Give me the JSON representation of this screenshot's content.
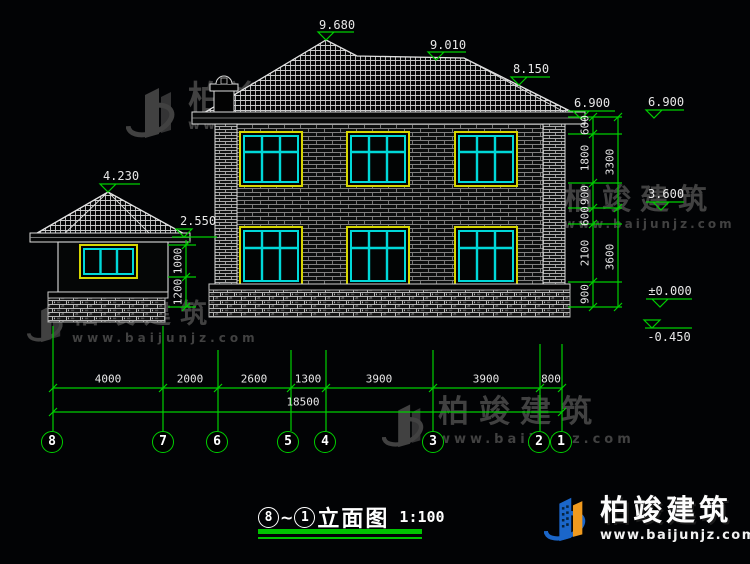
{
  "drawing": {
    "title": {
      "from_bubble": "8",
      "tilde": "~",
      "to_bubble": "1",
      "name": "立面图",
      "scale": "1:100"
    },
    "elevation_markers": {
      "main_ridge": "9.680",
      "ridge_right": "9.010",
      "roof_break": "8.150",
      "eave": "6.900",
      "eave_right": "6.900",
      "floor2": "3.600",
      "ground": "±0.000",
      "footing": "-0.450",
      "porch_ridge": "4.230",
      "porch_eave": "2.550"
    },
    "dims": {
      "bottom_row": [
        "4000",
        "2000",
        "2600",
        "1300",
        "3900",
        "3900",
        "800"
      ],
      "bottom_total": "18500",
      "right_chain": [
        "600",
        "1800",
        "900",
        "600",
        "2100",
        "900"
      ],
      "right_totals": [
        "3300",
        "3600"
      ],
      "left_chain": [
        "1000",
        "1200"
      ]
    },
    "grid_bubbles": [
      "8",
      "7",
      "6",
      "5",
      "4",
      "3",
      "2",
      "1"
    ]
  },
  "watermark": {
    "brand": "柏竣建筑",
    "url": "www.baijunjz.com"
  },
  "logo": {
    "brand": "柏竣建筑",
    "url": "www.baijunjz.com"
  },
  "colors": {
    "dim_green": "#00cf00",
    "line_white": "#e0e0e0",
    "window_cyan": "#00d9d9",
    "window_yellow": "#d6d600",
    "watermark_gray": "#414141",
    "logo_blue": "#1b66c9",
    "logo_orange": "#f09a1e"
  }
}
